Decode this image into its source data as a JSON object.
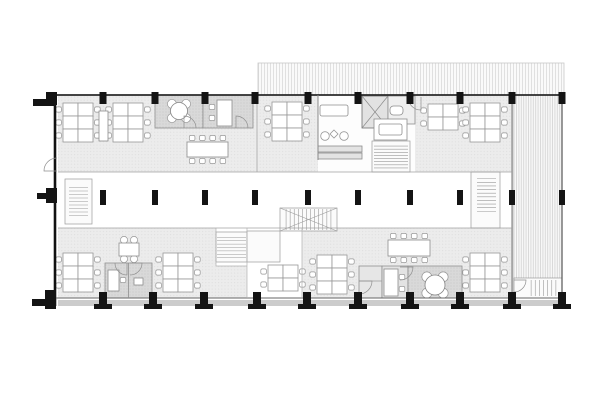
{
  "plan": {
    "canvas": {
      "w": 605,
      "h": 400
    },
    "palette": {
      "paper": "#ffffff",
      "column_black": "#141414",
      "wall_dark": "#1d1d1d",
      "wall_light": "#a0a0a0",
      "floor_fill": "#ececec",
      "room_fill": "#d9d9d9",
      "hatch_line": "#d2d2d2",
      "furniture_stroke": "#979797",
      "plinth": "#cccccc"
    },
    "hatches": [
      {
        "name": "roof-hatch-top",
        "x": 258,
        "y": 63,
        "w": 306,
        "h": 32,
        "pat": "vlines",
        "s": "#c9c9c9"
      },
      {
        "name": "terrace-hatch-east",
        "x": 513,
        "y": 95,
        "w": 49,
        "h": 203,
        "pat": "vlines2",
        "s": "#c9c9c9"
      }
    ],
    "floors": [
      {
        "name": "floor-upper",
        "x": 58,
        "y": 95,
        "w": 454,
        "h": 77
      },
      {
        "name": "floor-lower-west",
        "x": 58,
        "y": 228,
        "w": 158,
        "h": 70
      },
      {
        "name": "floor-lower-center",
        "x": 216,
        "y": 266,
        "w": 31,
        "h": 32
      },
      {
        "name": "floor-lower-east",
        "x": 302,
        "y": 228,
        "w": 210,
        "h": 70
      }
    ],
    "rooms": [
      {
        "name": "plinth-band",
        "x": 58,
        "y": 300,
        "w": 504,
        "h": 6,
        "f": "#cccccc"
      },
      {
        "name": "lounge-zone",
        "x": 318,
        "y": 95,
        "w": 97,
        "h": 77,
        "f": "#fdfdfd"
      },
      {
        "name": "meeting-room-a",
        "x": 155,
        "y": 95,
        "w": 48,
        "h": 33,
        "f": "pat:dotsD",
        "s": "#8f8f8f"
      },
      {
        "name": "meeting-room-b",
        "x": 203,
        "y": 95,
        "w": 50,
        "h": 33,
        "f": "pat:dotsD",
        "s": "#8f8f8f"
      },
      {
        "name": "focus-booths",
        "x": 105,
        "y": 263,
        "w": 47,
        "h": 35,
        "f": "pat:dotsD",
        "s": "#8f8f8f"
      },
      {
        "name": "wc-cell",
        "x": 359,
        "y": 266,
        "w": 23,
        "h": 32,
        "f": "#e6e6e6",
        "s": "#8f8f8f"
      },
      {
        "name": "phone-booth",
        "x": 382,
        "y": 266,
        "w": 26,
        "h": 32,
        "f": "#e3e3e3",
        "s": "#8f8f8f"
      },
      {
        "name": "meeting-room-c",
        "x": 408,
        "y": 266,
        "w": 54,
        "h": 32,
        "f": "pat:dotsD",
        "s": "#8f8f8f"
      },
      {
        "name": "elevator",
        "x": 362,
        "y": 96,
        "w": 26,
        "h": 32,
        "f": "#e2e2e2",
        "s": "#6e6e6e",
        "cross": true
      },
      {
        "name": "wc",
        "x": 388,
        "y": 96,
        "w": 27,
        "h": 28,
        "f": "#efefef",
        "s": "#8f8f8f"
      }
    ],
    "walls": [
      {
        "x1": 46,
        "y1": 95,
        "x2": 563,
        "y2": 95,
        "w": 1.8,
        "c": "#2a2a2a"
      },
      {
        "x1": 55,
        "y1": 95,
        "x2": 55,
        "y2": 306,
        "w": 2.6,
        "c": "#111111"
      },
      {
        "x1": 46,
        "y1": 298,
        "x2": 563,
        "y2": 298,
        "w": 1,
        "c": "#666666"
      },
      {
        "x1": 562,
        "y1": 95,
        "x2": 562,
        "y2": 298,
        "w": 1.2,
        "c": "#555555"
      },
      {
        "x1": 512,
        "y1": 95,
        "x2": 512,
        "y2": 298,
        "w": 1,
        "c": "#777777"
      },
      {
        "x1": 58,
        "y1": 172,
        "x2": 512,
        "y2": 172,
        "w": 0.8,
        "c": "#a0a0a0"
      },
      {
        "x1": 58,
        "y1": 228,
        "x2": 512,
        "y2": 228,
        "w": 0.8,
        "c": "#a0a0a0"
      },
      {
        "x1": 257,
        "y1": 95,
        "x2": 257,
        "y2": 172,
        "w": 0.8,
        "c": "#a8a8a8"
      },
      {
        "x1": 318,
        "y1": 95,
        "x2": 318,
        "y2": 160,
        "w": 1,
        "c": "#8a8a8a"
      },
      {
        "x1": 216,
        "y1": 228,
        "x2": 216,
        "y2": 266,
        "w": 0.7,
        "c": "#b0b0b0"
      },
      {
        "x1": 247,
        "y1": 228,
        "x2": 247,
        "y2": 298,
        "w": 0.7,
        "c": "#b0b0b0"
      },
      {
        "x1": 302,
        "y1": 228,
        "x2": 302,
        "y2": 298,
        "w": 0.7,
        "c": "#b0b0b0"
      },
      {
        "x1": 216,
        "y1": 266,
        "x2": 247,
        "y2": 266,
        "w": 0.7,
        "c": "#b0b0b0"
      },
      {
        "x1": 128.5,
        "y1": 263,
        "x2": 128.5,
        "y2": 298,
        "w": 0.8,
        "c": "#8f8f8f"
      },
      {
        "x1": 359,
        "y1": 281,
        "x2": 382,
        "y2": 281,
        "w": 0.7,
        "c": "#9a9a9a"
      }
    ],
    "stairs": [
      {
        "name": "stair-core",
        "frame": [
          372,
          141,
          38,
          31
        ],
        "x": 374,
        "y": 143,
        "w": 34,
        "h": 28,
        "dir": "v",
        "n": 9
      },
      {
        "name": "stair-west",
        "frame": [
          65,
          179,
          27,
          45
        ],
        "x": 69,
        "y": 184,
        "w": 19,
        "h": 35,
        "dir": "v",
        "n": 10
      },
      {
        "name": "stair-east",
        "frame": [
          471,
          172,
          29,
          56
        ],
        "x": 477,
        "y": 175,
        "w": 19,
        "h": 40,
        "dir": "v",
        "n": 11
      },
      {
        "name": "stair-central-upper",
        "frame": [
          280,
          208,
          57,
          23
        ],
        "x": 282,
        "y": 209,
        "w": 53,
        "h": 21,
        "dir": "h",
        "n": 13,
        "cross": true
      },
      {
        "name": "stair-central-lower",
        "frame": [
          216,
          232,
          31,
          30
        ],
        "x": 217,
        "y": 234,
        "w": 29,
        "h": 27,
        "dir": "v",
        "n": 8
      },
      {
        "name": "stair-landing",
        "frame": [
          247,
          231,
          33,
          31
        ],
        "x": 0,
        "y": 0,
        "w": 0,
        "h": 0,
        "dir": "v",
        "n": 0
      },
      {
        "name": "stair-exit",
        "frame": [
          514,
          278,
          48,
          20
        ],
        "x": 527,
        "y": 280,
        "w": 33,
        "h": 16,
        "dir": "h",
        "n": 8
      }
    ],
    "doors": [
      {
        "name": "door-west-entry",
        "hx": 57,
        "hy": 171,
        "r": 13,
        "a0": 180,
        "a1": 270
      },
      {
        "name": "door-meeting-a",
        "hx": 184,
        "hy": 128,
        "r": 12,
        "a0": 270,
        "a1": 0
      },
      {
        "name": "door-meeting-b",
        "hx": 236,
        "hy": 128,
        "r": 12,
        "a0": 270,
        "a1": 0
      },
      {
        "name": "door-office-east",
        "hx": 421,
        "hy": 97,
        "r": 13,
        "a0": 90,
        "a1": 180
      },
      {
        "name": "door-booth-left",
        "hx": 127,
        "hy": 263,
        "r": 12,
        "a0": 90,
        "a1": 180
      },
      {
        "name": "door-booth-right",
        "hx": 130,
        "hy": 263,
        "r": 12,
        "a0": 0,
        "a1": 90
      },
      {
        "name": "door-wc-cell",
        "hx": 359,
        "hy": 281,
        "r": 13,
        "a0": 0,
        "a1": 90
      },
      {
        "name": "door-meeting-c",
        "hx": 400,
        "hy": 267,
        "r": 13,
        "a0": 0,
        "a1": 90
      },
      {
        "name": "door-exit-stair",
        "hx": 514,
        "hy": 280,
        "r": 12,
        "a0": 0,
        "a1": 90
      }
    ],
    "furniture": {
      "desk_clusters": [
        {
          "name": "desk-cluster-nw-1",
          "x": 63,
          "y": 103,
          "cols": 2,
          "rows": 3
        },
        {
          "name": "desk-cluster-nw-2",
          "x": 113,
          "y": 103,
          "cols": 2,
          "rows": 3
        },
        {
          "name": "desk-cluster-n-center",
          "x": 272,
          "y": 102,
          "cols": 2,
          "rows": 3
        },
        {
          "name": "desk-cluster-ne-1",
          "x": 428,
          "y": 104,
          "cols": 2,
          "rows": 2
        },
        {
          "name": "desk-cluster-ne-2",
          "x": 470,
          "y": 103,
          "cols": 2,
          "rows": 3
        },
        {
          "name": "desk-cluster-sw-1",
          "x": 63,
          "y": 253,
          "cols": 2,
          "rows": 3
        },
        {
          "name": "desk-cluster-sw-2",
          "x": 163,
          "y": 253,
          "cols": 2,
          "rows": 3
        },
        {
          "name": "desk-cluster-s-center",
          "x": 268,
          "y": 265,
          "cols": 2,
          "rows": 2
        },
        {
          "name": "desk-cluster-s-mid",
          "x": 317,
          "y": 255,
          "cols": 2,
          "rows": 3
        },
        {
          "name": "desk-cluster-se",
          "x": 470,
          "y": 253,
          "cols": 2,
          "rows": 3
        }
      ],
      "desk_size": {
        "w": 15,
        "h": 13
      },
      "conference_tables": [
        {
          "name": "conference-table-north",
          "x": 187,
          "y": 142,
          "w": 41,
          "h": 15,
          "seats": 4
        },
        {
          "name": "conference-table-south",
          "x": 388,
          "y": 240,
          "w": 42,
          "h": 16,
          "seats": 4
        }
      ],
      "round_tables": [
        {
          "name": "round-table-meeting-a",
          "cx": 179,
          "cy": 111,
          "r": 8.5,
          "chairR": 4.5,
          "d": 10
        },
        {
          "name": "round-table-meeting-c",
          "cx": 435,
          "cy": 285,
          "r": 10,
          "chairR": 5,
          "d": 11.5
        }
      ],
      "square_tables": [
        {
          "name": "table-four-seat",
          "x": 119,
          "y": 243,
          "w": 20,
          "h": 13
        }
      ],
      "misc_rects": [
        {
          "name": "room-b-desk",
          "x": 217,
          "y": 100,
          "w": 15,
          "h": 26
        },
        {
          "name": "cabinet",
          "x": 99,
          "y": 111,
          "w": 9,
          "h": 30
        },
        {
          "name": "booth-desk",
          "x": 108,
          "y": 270,
          "w": 11,
          "h": 21
        },
        {
          "name": "booth-table",
          "x": 134,
          "y": 278,
          "w": 9,
          "h": 7
        },
        {
          "name": "phone-desk",
          "x": 384,
          "y": 269,
          "w": 14,
          "h": 27
        },
        {
          "name": "kitchen-counter",
          "x": 374,
          "y": 119,
          "w": 33,
          "h": 21
        },
        {
          "name": "kitchen-island",
          "x": 379,
          "y": 124,
          "w": 23,
          "h": 11,
          "rx": 2
        },
        {
          "name": "sofa",
          "x": 320,
          "y": 105,
          "w": 28,
          "h": 11,
          "rx": 2
        },
        {
          "name": "counter-1",
          "x": 318,
          "y": 146,
          "w": 44,
          "h": 6,
          "f": "#e3e3e3"
        },
        {
          "name": "counter-2",
          "x": 318,
          "y": 153,
          "w": 44,
          "h": 6,
          "f": "#e3e3e3"
        },
        {
          "name": "toilet",
          "x": 390,
          "y": 106,
          "w": 13,
          "h": 9,
          "rx": 3.5
        }
      ],
      "loose_chairs": [
        [
          212,
          107
        ],
        [
          212,
          118
        ],
        [
          123,
          280
        ],
        [
          402,
          277
        ],
        [
          402,
          289
        ]
      ],
      "lounge_chairs": [
        [
          325,
          136,
          4.3
        ],
        [
          344,
          136,
          4.3
        ]
      ],
      "coffee_table_diamond": [
        334,
        134,
        4
      ]
    },
    "columns": {
      "top_xs": [
        103,
        155,
        205,
        255,
        308,
        358,
        410,
        460,
        512,
        562
      ],
      "mid_xs": [
        103,
        155,
        205,
        255,
        308,
        358,
        410,
        460,
        512,
        562
      ],
      "bottom_xs": [
        103,
        153,
        204,
        257,
        307,
        358,
        410,
        460,
        512,
        562
      ],
      "special_rects": [
        [
          33,
          99,
          22,
          7
        ],
        [
          46,
          92,
          11,
          13
        ],
        [
          37,
          193,
          18,
          6
        ],
        [
          46,
          188,
          11,
          15
        ],
        [
          32,
          299,
          23,
          7
        ],
        [
          45,
          290,
          11,
          19
        ]
      ]
    }
  }
}
